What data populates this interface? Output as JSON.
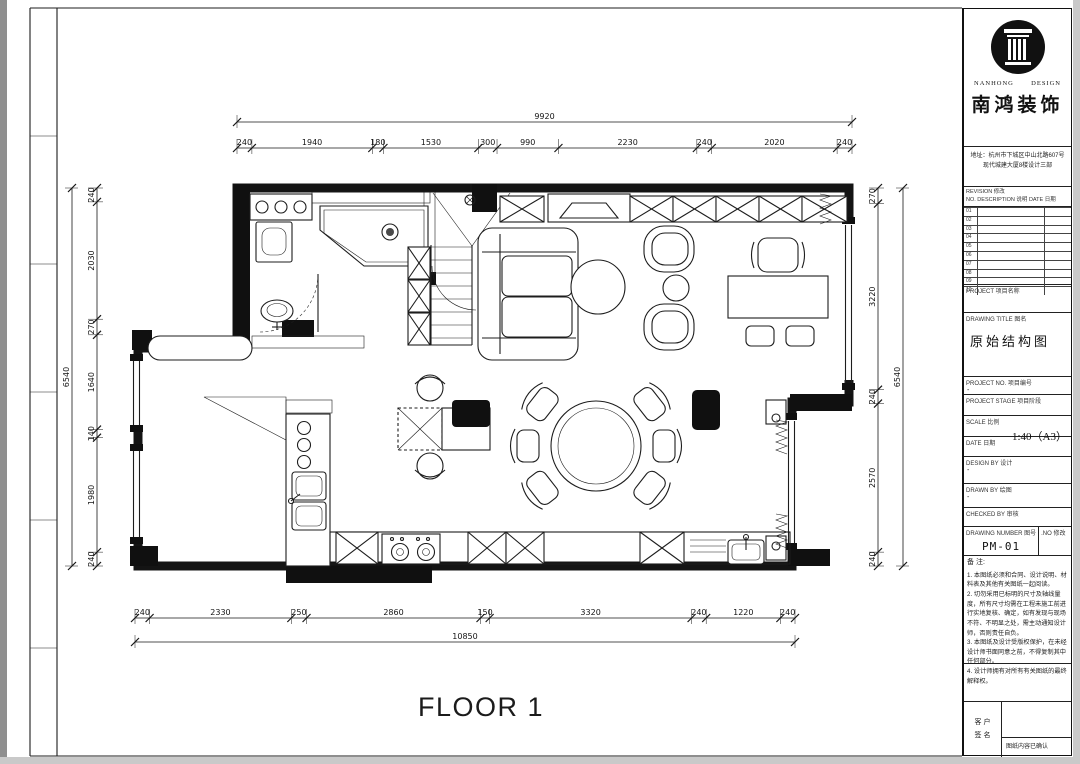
{
  "page": {
    "floor_label": "FLOOR 1"
  },
  "title_block": {
    "logo": {
      "latin_left": "NANHONG",
      "latin_right": "DESIGN",
      "cn_name": "南鸿装饰",
      "mark": "column-logo"
    },
    "address_line1": "地址：杭州市下城区中山北路607号",
    "address_line2": "现代城建大厦8楼设计三部",
    "revision": {
      "label_line1": "REVISION 修改",
      "label_line2": "NO.   DESCRIPTION 说明   DATE 日期",
      "rows": [
        "01",
        "02",
        "03",
        "04",
        "05",
        "06",
        "07",
        "08",
        "09",
        "10"
      ]
    },
    "fields": [
      {
        "en": "PROJECT",
        "cn": "项目名称",
        "value": ""
      },
      {
        "en": "DRAWING TITLE",
        "cn": "图名",
        "value": "原始结构图"
      },
      {
        "en": "PROJECT NO.",
        "cn": "项目编号",
        "value": "-"
      },
      {
        "en": "PROJECT STAGE",
        "cn": "项目阶段",
        "value": ""
      },
      {
        "en": "SCALE",
        "cn": "比例",
        "value": "-",
        "value2": "1:40（A3）"
      },
      {
        "en": "DATE",
        "cn": "日期",
        "value": ""
      },
      {
        "en": "DESIGN BY",
        "cn": "设计",
        "value": "-"
      },
      {
        "en": "DRAWN BY",
        "cn": "绘图",
        "value": "-"
      },
      {
        "en": "CHECKED BY",
        "cn": "审核",
        "value": ""
      }
    ],
    "drawing_number": {
      "en": "DRAWING NUMBER",
      "cn": "图号",
      "value": "PM-01",
      "right_en": ".NO",
      "right_cn": "修改"
    },
    "notes_title": "备 注:",
    "notes": [
      "1. 本图纸必须和合同、设计说明、材料表及其他有关图纸一起阅读。",
      "2. 切勿采用已标明的尺寸及轴线量度，所有尺寸均需在工程未施工前进行实地复核、确定，如有发现与现场不符、不明显之处，需主动通知设计师，否则责任自负。",
      "3. 本图纸及设计受版权保护，在未经设计师书面同意之前，不得复制其中任何部分。",
      "4. 设计师拥有对所有有关图纸的最终解释权。"
    ],
    "sign": {
      "left_line1": "客 户",
      "left_line2": "签 名",
      "confirm": "图纸内容已确认"
    }
  },
  "dimensions": {
    "top": {
      "total": "9920",
      "segments": [
        240,
        1940,
        180,
        1530,
        300,
        990,
        2230,
        240,
        2020,
        240
      ]
    },
    "bottom": {
      "total": "10850",
      "segments": [
        240,
        2330,
        250,
        2860,
        150,
        3320,
        240,
        1220,
        240
      ]
    },
    "left": {
      "total": "6540",
      "segments": [
        240,
        2030,
        270,
        1640,
        140,
        1980,
        240
      ]
    },
    "right": {
      "total": "6540",
      "segments": [
        270,
        3220,
        240,
        2570,
        240
      ]
    }
  },
  "plan": {
    "rooms": [
      "bathroom",
      "stairs",
      "living-room",
      "dining-area",
      "kitchen",
      "entry"
    ],
    "scale_note": "1:40（A3）",
    "drawing_title": "原始结构图"
  }
}
